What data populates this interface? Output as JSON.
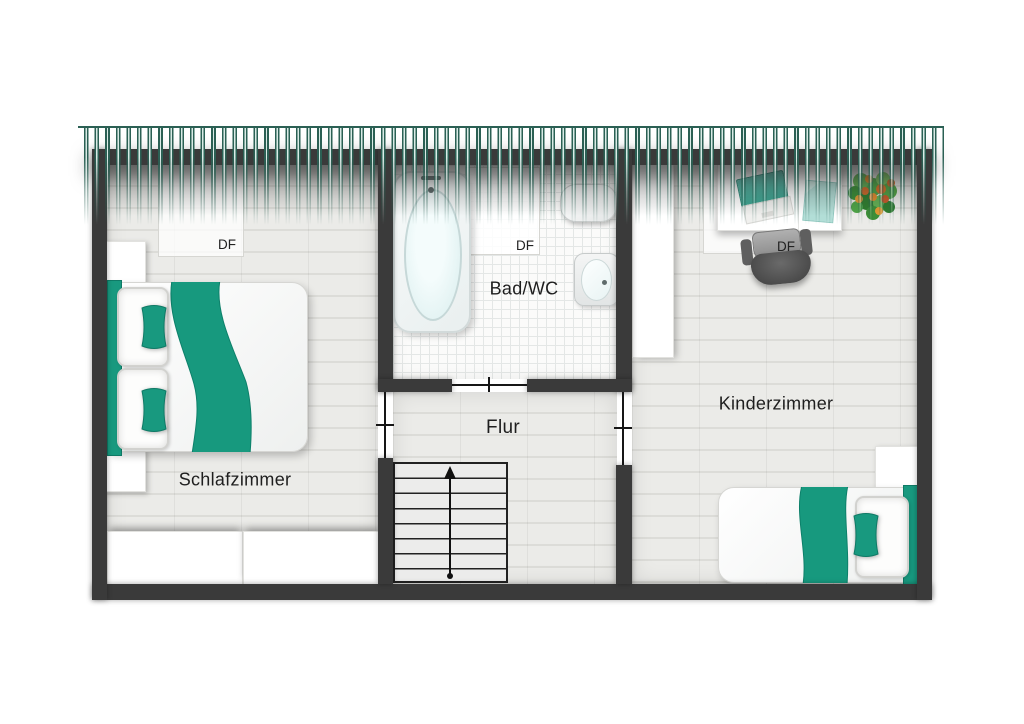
{
  "floorplan": {
    "rooms": [
      {
        "id": "schlafzimmer",
        "label": "Schlafzimmer"
      },
      {
        "id": "bad_wc",
        "label": "Bad/WC"
      },
      {
        "id": "flur",
        "label": "Flur"
      },
      {
        "id": "kinderzimmer",
        "label": "Kinderzimmer"
      }
    ],
    "roof_windows": [
      {
        "room": "schlafzimmer",
        "label": "DF"
      },
      {
        "room": "bad_wc",
        "label": "DF"
      },
      {
        "room": "kinderzimmer",
        "label": "DF"
      }
    ],
    "stairs": {
      "steps": 8,
      "direction": "up"
    },
    "colors": {
      "accent_teal": "#18997f",
      "wall": "#3a3a3a",
      "roof_hatch": "#2b6054"
    },
    "furniture": {
      "schlafzimmer": [
        "double-bed",
        "nightstand",
        "nightstand",
        "wardrobe",
        "wardrobe"
      ],
      "bad_wc": [
        "bathtub",
        "sink",
        "toilet"
      ],
      "kinderzimmer": [
        "wardrobe",
        "desk",
        "laptop",
        "paper",
        "office-chair",
        "potted-plant",
        "nightstand",
        "single-bed"
      ]
    }
  }
}
